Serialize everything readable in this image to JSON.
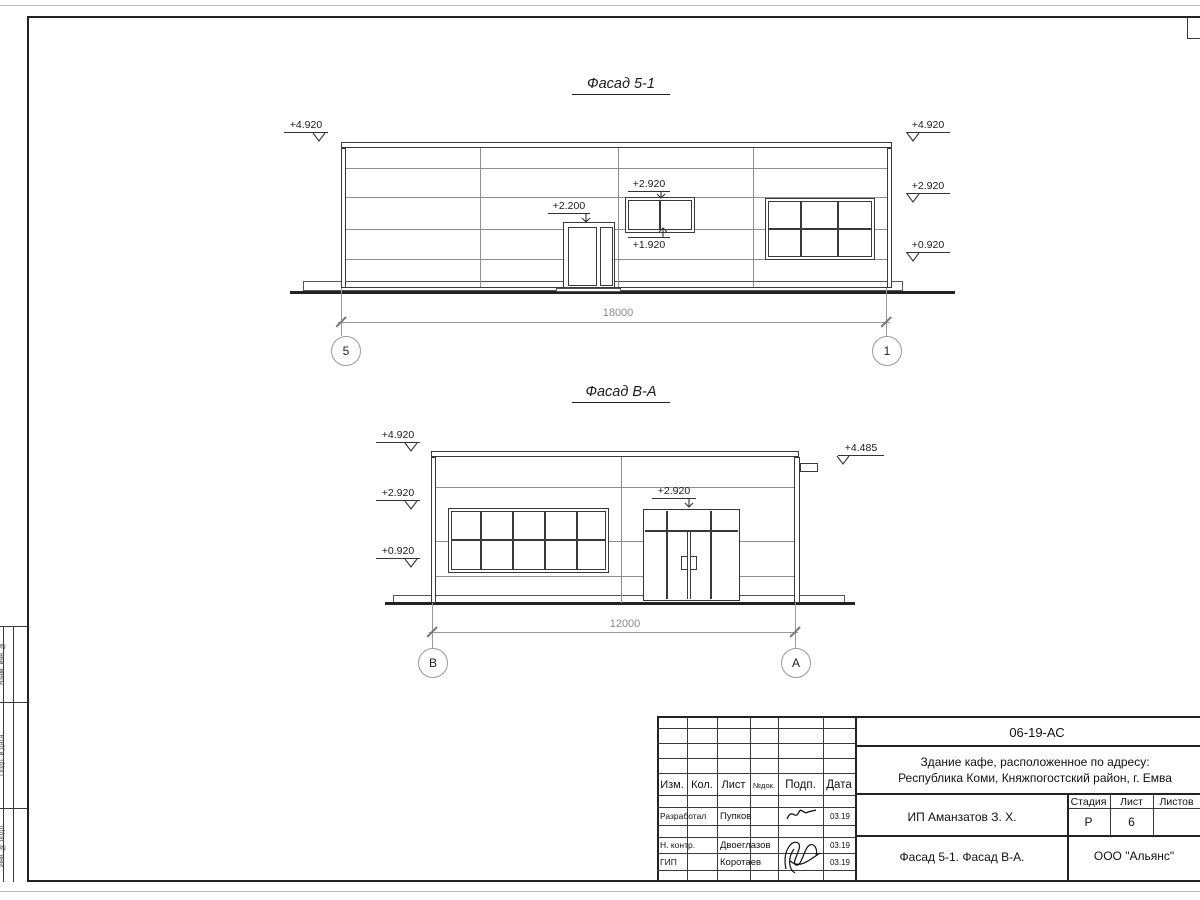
{
  "colors": {
    "line_dark": "#3a3a3a",
    "line_light": "#8f8f8f",
    "dim_gray": "#9a9a9a",
    "background": "#ffffff"
  },
  "facade51": {
    "title": "Фасад 5-1",
    "dim": "18000",
    "axis_left": "5",
    "axis_right": "1",
    "marks": {
      "left_top": "+4.920",
      "right_top": "+4.920",
      "right_mid": "+2.920",
      "right_low": "+0.920",
      "door": "+2.200",
      "win_top": "+2.920",
      "win_bot": "+1.920"
    }
  },
  "facadeBA": {
    "title": "Фасад В-А",
    "dim": "12000",
    "axis_left": "В",
    "axis_right": "А",
    "marks": {
      "left_top": "+4.920",
      "left_mid": "+2.920",
      "left_low": "+0.920",
      "right": "+4.485",
      "entrance": "+2.920"
    }
  },
  "titleblock": {
    "doc_number": "06-19-АС",
    "project_line1": "Здание кафе, расположенное по адресу:",
    "project_line2": "Республика Коми, Княжпогостский район, г. Емва",
    "client": "ИП Аманзатов З. Х.",
    "sheet_title": "Фасад 5-1. Фасад В-А.",
    "company": "ООО \"Альянс\"",
    "columns": {
      "izm": "Изм.",
      "kol": "Кол.",
      "list": "Лист",
      "ndok": "№док.",
      "podp": "Подп.",
      "data": "Дата"
    },
    "stage": {
      "h_stadia": "Стадия",
      "h_list": "Лист",
      "h_listov": "Листов",
      "stadia": "Р",
      "list": "6",
      "listov": ""
    },
    "rows": [
      {
        "role": "Разработал",
        "name": "Пупков",
        "date": "03.19"
      },
      {
        "role": "Н. контр.",
        "name": "Двоеглазов",
        "date": "03.19"
      },
      {
        "role": "ГИП",
        "name": "Коротаев",
        "date": "03.19"
      }
    ]
  },
  "margin": {
    "labels": [
      {
        "text": "Взам. инв. №"
      },
      {
        "text": "Подп. и дата"
      },
      {
        "text": "Инв. № подл."
      }
    ]
  }
}
